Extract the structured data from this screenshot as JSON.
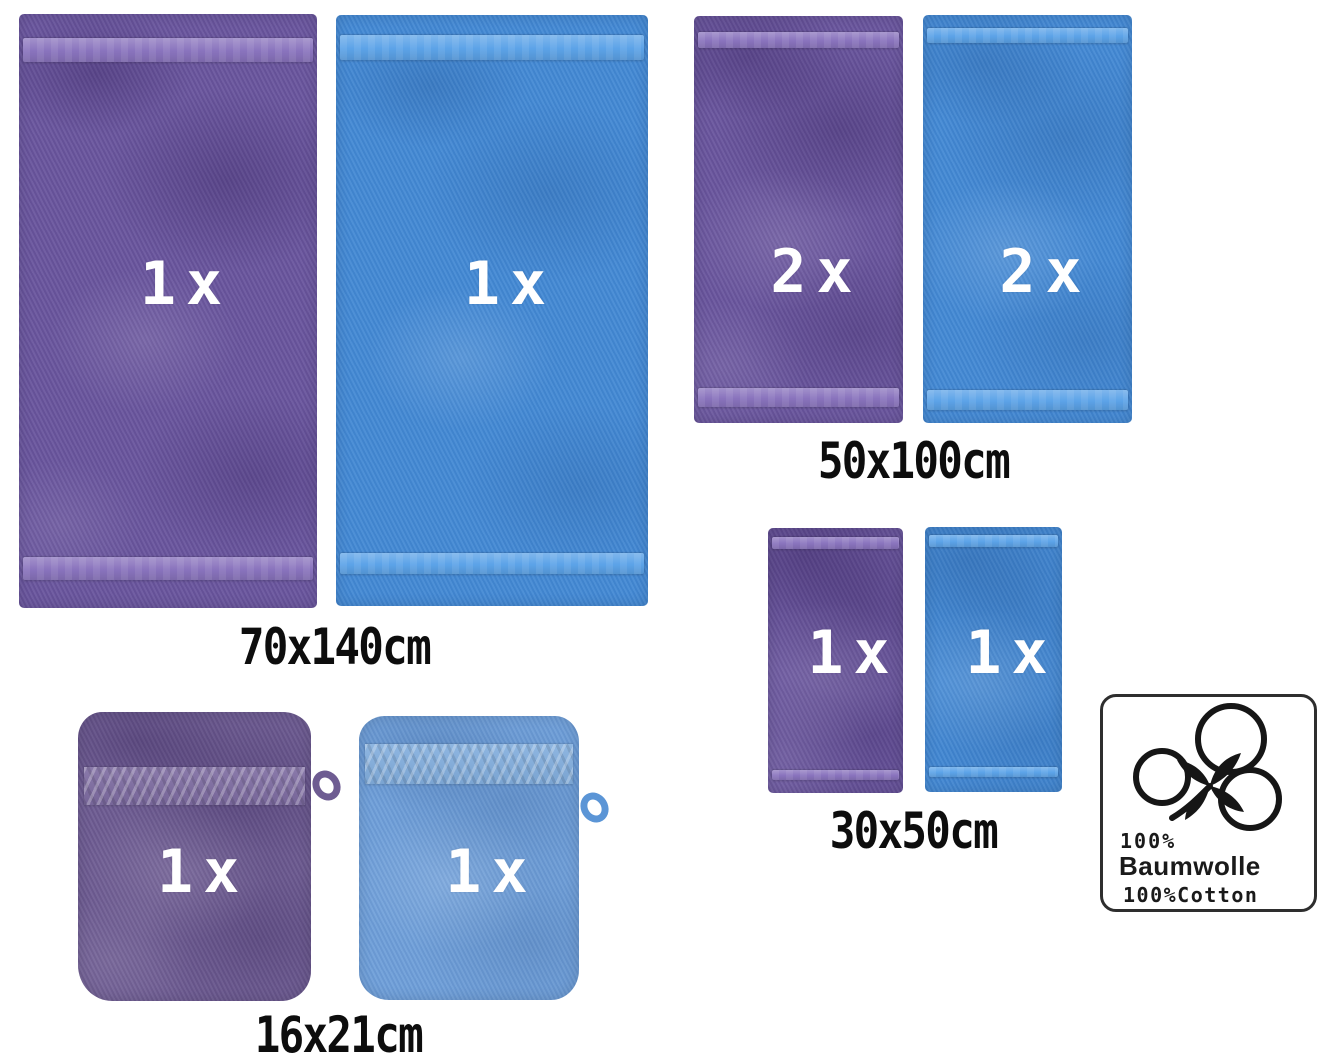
{
  "background_color": "#ffffff",
  "text_colors": {
    "caption": "#0d0d0d",
    "count_label": "#ffffff",
    "badge": "#1a1a1a"
  },
  "groups": [
    {
      "name": "bath-towels",
      "size_label": "70x140cm",
      "items": [
        {
          "color_name": "purple",
          "count_label": "1 x",
          "base_color": "#6a569e",
          "band_color": "#8973bd"
        },
        {
          "color_name": "blue",
          "count_label": "1 x",
          "base_color": "#4389d4",
          "band_color": "#5ca3e8"
        }
      ]
    },
    {
      "name": "hand-towels",
      "size_label": "50x100cm",
      "items": [
        {
          "color_name": "purple",
          "count_label": "2 x",
          "base_color": "#6a569e",
          "band_color": "#8973bd"
        },
        {
          "color_name": "blue",
          "count_label": "2 x",
          "base_color": "#4389d4",
          "band_color": "#5ca3e8"
        }
      ]
    },
    {
      "name": "guest-towels",
      "size_label": "30x50cm",
      "items": [
        {
          "color_name": "purple",
          "count_label": "1 x",
          "base_color": "#6a569e",
          "band_color": "#8973bd"
        },
        {
          "color_name": "blue",
          "count_label": "1 x",
          "base_color": "#4389d4",
          "band_color": "#5ca3e8"
        }
      ]
    },
    {
      "name": "wash-mitts",
      "size_label": "16x21cm",
      "items": [
        {
          "color_name": "purple",
          "count_label": "1 x",
          "base_color": "#6e5c92",
          "band_color": "#7d6ba1",
          "loop_color": "#6e5c92"
        },
        {
          "color_name": "blue",
          "count_label": "1 x",
          "base_color": "#6f9fd9",
          "band_color": "#82aede",
          "loop_color": "#5b95d6"
        }
      ]
    }
  ],
  "badge": {
    "icon": "cotton-flower-icon",
    "percent_line": "100%",
    "baumwolle_line": "Baumwolle",
    "cotton_line": "100%Cotton"
  }
}
